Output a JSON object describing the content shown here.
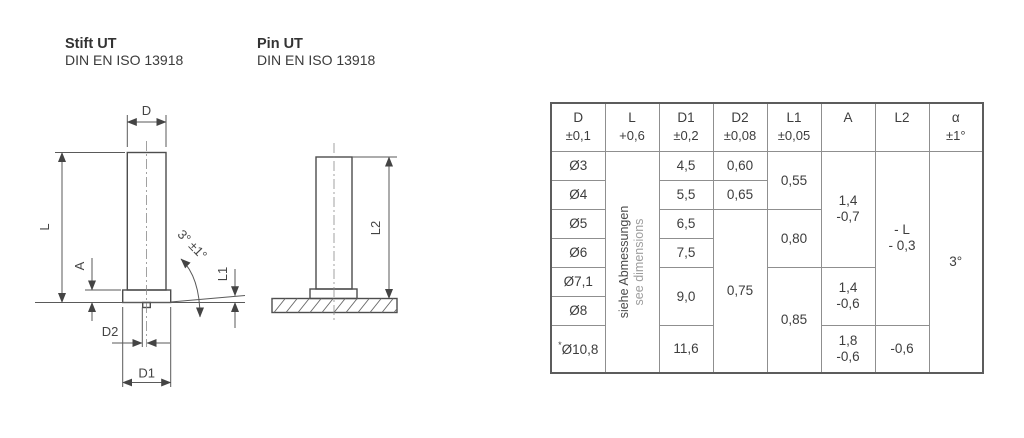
{
  "header": {
    "de": {
      "title": "Stift UT",
      "standard": "DIN EN ISO 13918"
    },
    "en": {
      "title": "Pin UT",
      "standard": "DIN EN ISO 13918"
    }
  },
  "drawings": {
    "front": {
      "dim_d": "D",
      "dim_l": "L",
      "dim_a": "A",
      "dim_angle": "3° ±1°",
      "dim_l1": "L1",
      "dim_d2": "D2",
      "dim_d1": "D1"
    },
    "welded": {
      "dim_l2": "L2"
    }
  },
  "table": {
    "headers": [
      {
        "name": "D",
        "tol": "±0,1"
      },
      {
        "name": "L",
        "tol": "+0,6"
      },
      {
        "name": "D1",
        "tol": "±0,2"
      },
      {
        "name": "D2",
        "tol": "±0,08"
      },
      {
        "name": "L1",
        "tol": "±0,05"
      },
      {
        "name": "A",
        "tol": ""
      },
      {
        "name": "L2",
        "tol": ""
      },
      {
        "name": "α",
        "tol": "±1°"
      }
    ],
    "l_note_de": "siehe Abmessungen",
    "l_note_en": "see dimensions",
    "rows_d": [
      "Ø3",
      "Ø4",
      "Ø5",
      "Ø6",
      "Ø7,1",
      "Ø8",
      "Ø10,8"
    ],
    "d_footnote_prefix": "*",
    "d1": [
      "4,5",
      "5,5",
      "6,5",
      "7,5",
      "9,0",
      "11,6"
    ],
    "d2": [
      "0,60",
      "0,65",
      "0,75"
    ],
    "l1": [
      "0,55",
      "0,80",
      "0,85"
    ],
    "a": [
      "1,4\n-0,7",
      "1,4\n-0,6",
      "1,8\n-0,6"
    ],
    "l2": [
      "- L\n- 0,3",
      "-0,6"
    ],
    "alpha": "3°"
  },
  "colors": {
    "part_line": "#4d4d4d",
    "dim_line": "#5a5a5a",
    "centerline": "#8a8a8a",
    "text": "#3d3d3d",
    "muted_text": "#9d9d9d",
    "border_inner": "#8f8f8f",
    "border_outer": "#5c5c5c"
  }
}
